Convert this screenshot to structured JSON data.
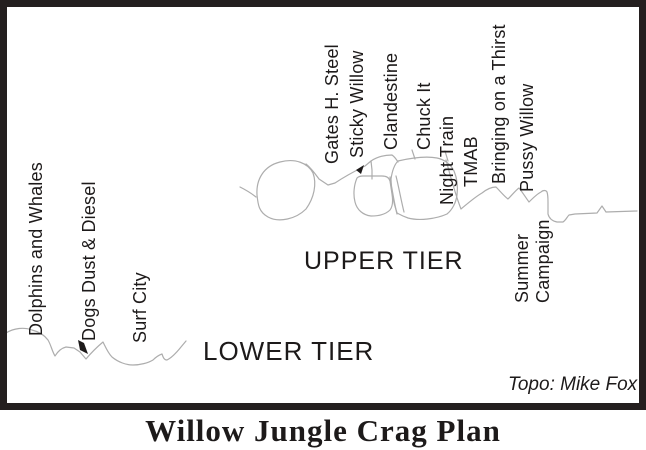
{
  "title": "Willow Jungle Crag Plan",
  "credit": "Topo: Mike Fox",
  "tiers": {
    "upper": {
      "label": "UPPER TIER"
    },
    "lower": {
      "label": "LOWER TIER"
    }
  },
  "routes": {
    "upper": [
      {
        "label": "Gates H. Steel"
      },
      {
        "label": "Sticky Willow"
      },
      {
        "label": "Clandestine"
      },
      {
        "label": "Chuck It"
      },
      {
        "label": "Night Train"
      },
      {
        "label": "TMAB"
      },
      {
        "label": "Bringing on a Thirst"
      },
      {
        "label": "Pussy Willow"
      },
      {
        "label": "Summer\nCampaign"
      }
    ],
    "lower": [
      {
        "label": "Dolphins and Whales"
      },
      {
        "label": "Dogs Dust & Diesel"
      },
      {
        "label": "Surf City"
      }
    ]
  },
  "colors": {
    "outline": "#adadad",
    "ink": "#1d1a1a",
    "frame": "#241f1f",
    "background": "#ffffff"
  }
}
